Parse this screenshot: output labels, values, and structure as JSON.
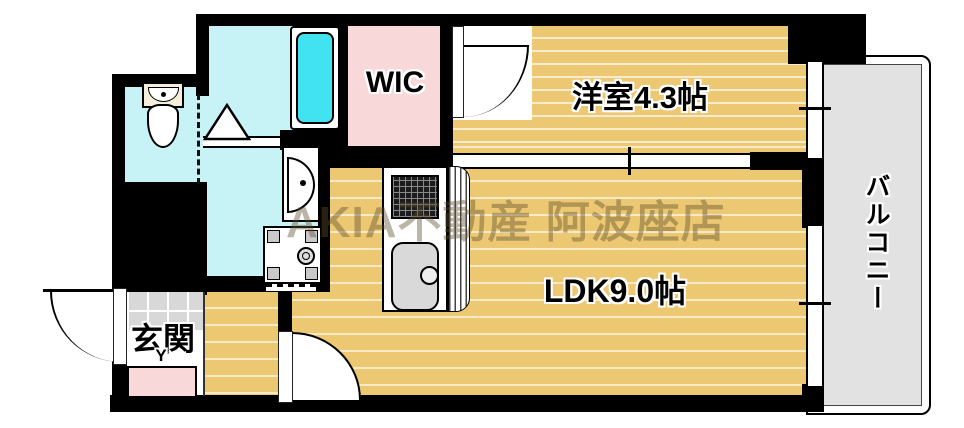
{
  "plan": {
    "title": "apartment-floor-plan",
    "labels": {
      "western_room": "洋室4.3帖",
      "ldk": "LDK9.0帖",
      "wic": "WIC",
      "entrance": "玄関",
      "balcony": "バルコニー",
      "entrance_step_mark": "Y"
    },
    "watermark": "AKIA不動産 阿波座店",
    "colors": {
      "wood": "#edc873",
      "cyan": "#c7f3f7",
      "pink": "#f8d8d8",
      "gray": "#e2e2e2",
      "tile": "#d8d8d8",
      "tub": "#42e3f0",
      "wall": "#000000"
    },
    "fixtures": [
      "toilet",
      "bathtub",
      "bath-door-triangle",
      "washbasin",
      "washing-machine",
      "gas-stove",
      "kitchen-sink",
      "kitchen-counter",
      "shoe-cabinet",
      "entrance-tile"
    ]
  }
}
